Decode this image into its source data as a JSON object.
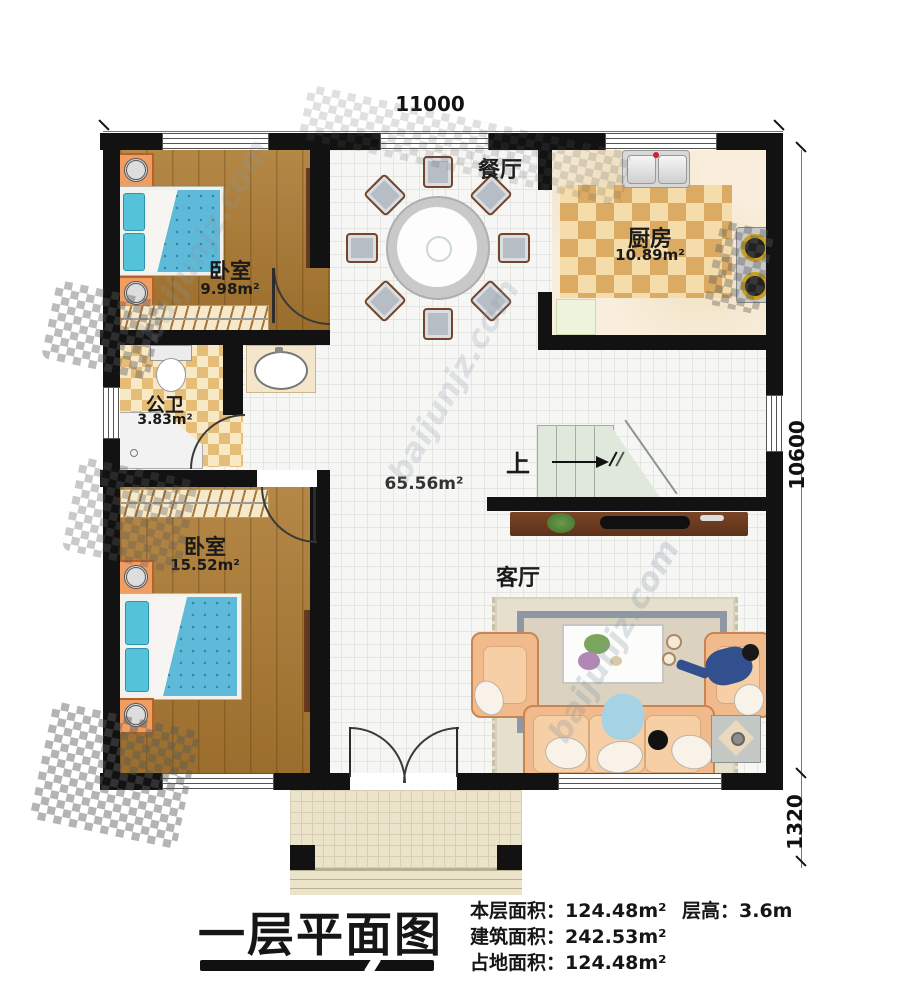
{
  "watermark": {
    "text": "baijunjz.com"
  },
  "dimensions": {
    "top_width": "11000",
    "right_height": "10600",
    "right_porch": "1320"
  },
  "rooms": {
    "dining": {
      "label": "餐厅"
    },
    "kitchen": {
      "label": "厨房",
      "area": "10.89m²"
    },
    "bedroom_top": {
      "label": "卧室",
      "area": "9.98m²"
    },
    "bathroom": {
      "label": "公卫",
      "area": "3.83m²"
    },
    "bedroom_bottom": {
      "label": "卧室",
      "area": "15.52m²"
    },
    "living": {
      "label": "客厅"
    },
    "open_area": {
      "area": "65.56m²"
    },
    "stairs": {
      "label": "上"
    }
  },
  "footer": {
    "title": "一层平面图",
    "stats": [
      {
        "label": "本层面积：",
        "value": "124.48m²"
      },
      {
        "label": "建筑面积：",
        "value": "242.53m²"
      },
      {
        "label": "占地面积：",
        "value": "124.48m²"
      }
    ],
    "height_label": "层高：",
    "height_value": "3.6m"
  },
  "colors": {
    "wall": "#121212",
    "wood_floor": "#ac7a31",
    "checker_dark": "#dcab63",
    "checker_light": "#f4ddab",
    "bed_blue": "#5fb9d9",
    "sofa_peach": "#f1ba8d",
    "stairs_green": "#dfe8db"
  }
}
